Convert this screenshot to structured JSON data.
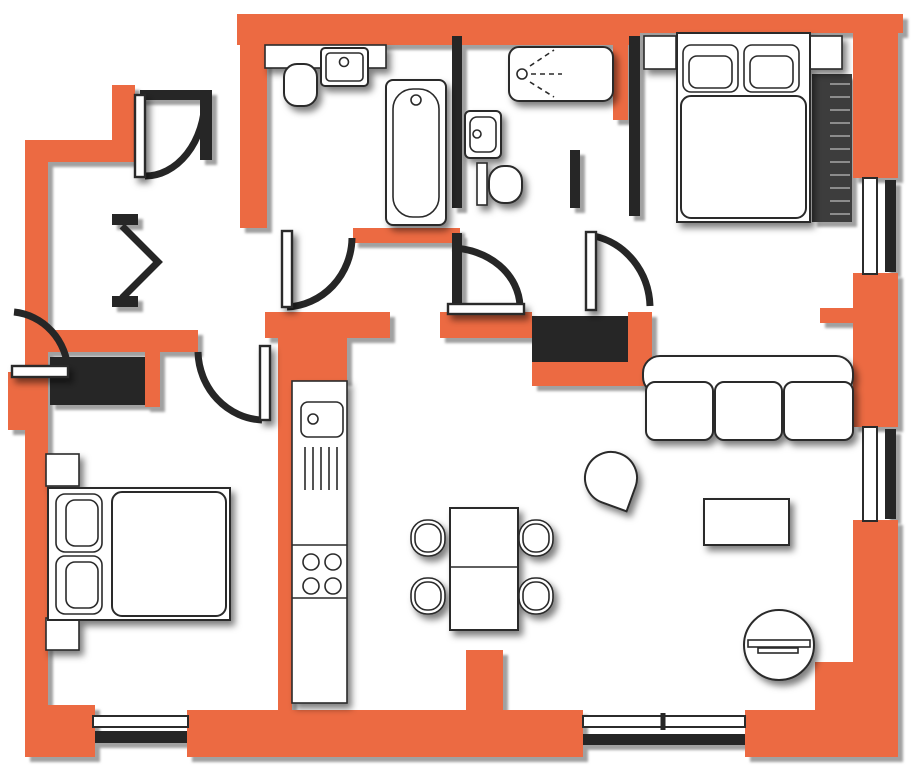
{
  "document": {
    "type": "floor-plan",
    "label": "apartment-floor-plan",
    "has_text": false
  },
  "colors": {
    "wall": "#EC6A42",
    "iwall": "#262626",
    "line": "#2b2b2b",
    "furn": "#FFFFFF",
    "bg": "#FFFFFF",
    "stripe": "#8c8c8c",
    "wardrobe": "#3d3d3d",
    "shadow_wall": "#9B9B9B",
    "shadow_furniture": "#000000"
  },
  "rooms": [
    {
      "id": "hall",
      "label": "hallway",
      "items": [
        "entry-door",
        "bifold-closet-door",
        "built-in-wardrobe"
      ]
    },
    {
      "id": "bathroom",
      "label": "bathroom",
      "items": [
        "vanity-counter",
        "sink",
        "toilet",
        "bathtub",
        "door"
      ]
    },
    {
      "id": "shower-room",
      "label": "shower room",
      "items": [
        "shower-tray",
        "sink",
        "toilet"
      ]
    },
    {
      "id": "master-bedroom",
      "label": "master bedroom",
      "items": [
        "double-bed",
        "pillow",
        "pillow",
        "nightstand",
        "nightstand",
        "wardrobe",
        "window",
        "door"
      ]
    },
    {
      "id": "bedroom-2",
      "label": "second bedroom",
      "items": [
        "double-bed",
        "pillow",
        "pillow",
        "nightstand",
        "nightstand",
        "wardrobe",
        "window",
        "door"
      ]
    },
    {
      "id": "kitchen",
      "label": "kitchen",
      "items": [
        "counter-run",
        "sink",
        "drainer",
        "hob-4-burners"
      ]
    },
    {
      "id": "dining",
      "label": "dining area",
      "items": [
        "table",
        "chair",
        "chair",
        "chair",
        "chair"
      ]
    },
    {
      "id": "living-room",
      "label": "living room",
      "items": [
        "sofa-3-seat",
        "armchair",
        "coffee-table",
        "round-side-table",
        "window",
        "window",
        "door"
      ]
    }
  ],
  "counts": {
    "windows": 4,
    "door_swings": 7,
    "rooms": 8
  }
}
